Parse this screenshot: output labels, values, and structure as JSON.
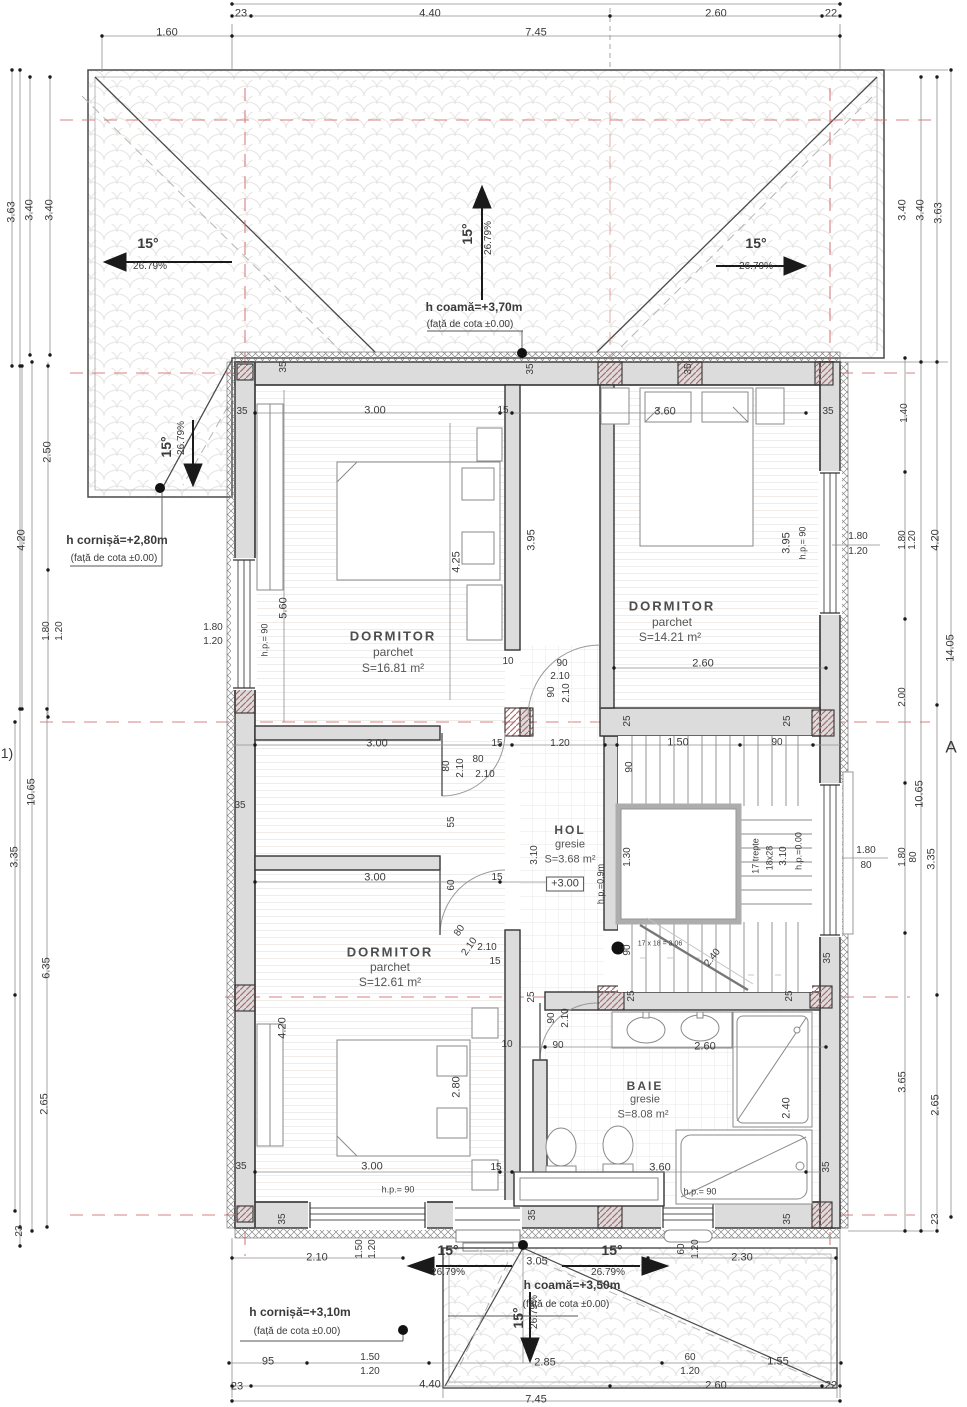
{
  "plan": {
    "rooms": [
      {
        "name": "DORMITOR",
        "floor": "parchet",
        "area": "S=16.81 m²"
      },
      {
        "name": "DORMITOR",
        "floor": "parchet",
        "area": "S=14.21 m²"
      },
      {
        "name": "DORMITOR",
        "floor": "parchet",
        "area": "S=12.61 m²"
      },
      {
        "name": "HOL",
        "floor": "gresie",
        "area": "S=3.68 m²"
      },
      {
        "name": "BAIE",
        "floor": "gresie",
        "area": "S=8.08 m²"
      }
    ],
    "level_marker": "+3.00",
    "roof": {
      "slope_deg": "15°",
      "slope_pct": "26.79%",
      "ridge_top": "h coamă=+3,70m",
      "eave_left": "h cornișă=+2,80m",
      "ridge_bottom": "h coamă=+3,50m",
      "eave_bottom": "h cornișă=+3,10m",
      "datum_note": "(față de cota ±0.00)"
    },
    "stairs": {
      "steps": "17 trepte",
      "tread": "18x28",
      "rise_total": "3.10",
      "formula": "17 x 18 = 3.06"
    },
    "axis_markers": {
      "left": "1)",
      "right": "A"
    },
    "colors": {
      "axis_red": "#d06a6a",
      "wall_fill": "#dcdcdc",
      "pier_hatch": "#b06a6d",
      "line": "#4a4a4a"
    }
  },
  "labels": [
    {
      "t": "23",
      "x": 241,
      "y": 14,
      "n": "dim"
    },
    {
      "t": "4.40",
      "x": 430,
      "y": 14,
      "n": "dim"
    },
    {
      "t": "2.60",
      "x": 716,
      "y": 14,
      "n": "dim"
    },
    {
      "t": "22",
      "x": 831,
      "y": 14,
      "n": "dim"
    },
    {
      "t": "1.60",
      "x": 167,
      "y": 33,
      "n": "dim"
    },
    {
      "t": "7.45",
      "x": 536,
      "y": 33,
      "n": "dim"
    },
    {
      "t": "3.63",
      "x": 12,
      "y": 212,
      "r": -90,
      "n": "dim"
    },
    {
      "t": "3.40",
      "x": 30,
      "y": 210,
      "r": -90,
      "n": "dim"
    },
    {
      "t": "3.40",
      "x": 50,
      "y": 210,
      "r": -90,
      "n": "dim"
    },
    {
      "t": "2.50",
      "x": 48,
      "y": 452,
      "r": -90,
      "n": "dim"
    },
    {
      "t": "4.20",
      "x": 22,
      "y": 540,
      "r": -90,
      "n": "dim"
    },
    {
      "t": "1.80",
      "x": 47,
      "y": 631,
      "r": -90,
      "s": 10,
      "n": "dim"
    },
    {
      "t": "1.20",
      "x": 60,
      "y": 631,
      "r": -90,
      "s": 10,
      "n": "dim"
    },
    {
      "t": "10.65",
      "x": 32,
      "y": 792,
      "r": -90,
      "n": "dim"
    },
    {
      "t": "3.35",
      "x": 15,
      "y": 857,
      "r": -90,
      "n": "dim"
    },
    {
      "t": "6.35",
      "x": 47,
      "y": 968,
      "r": -90,
      "n": "dim"
    },
    {
      "t": "2.65",
      "x": 45,
      "y": 1104,
      "r": -90,
      "n": "dim"
    },
    {
      "t": "23",
      "x": 20,
      "y": 1231,
      "r": -90,
      "s": 10,
      "n": "dim"
    },
    {
      "t": "1)",
      "x": 7,
      "y": 753,
      "s": 14,
      "n": "axis-marker"
    },
    {
      "t": "3.40",
      "x": 903,
      "y": 210,
      "r": -90,
      "n": "dim"
    },
    {
      "t": "3.40",
      "x": 921,
      "y": 210,
      "r": -90,
      "n": "dim"
    },
    {
      "t": "3.63",
      "x": 939,
      "y": 213,
      "r": -90,
      "n": "dim"
    },
    {
      "t": "1.40",
      "x": 905,
      "y": 413,
      "r": -90,
      "s": 10,
      "n": "dim"
    },
    {
      "t": "1.80",
      "x": 903,
      "y": 540,
      "r": -90,
      "s": 10,
      "n": "dim"
    },
    {
      "t": "1.20",
      "x": 913,
      "y": 540,
      "r": -90,
      "s": 10,
      "n": "dim"
    },
    {
      "t": "4.20",
      "x": 936,
      "y": 540,
      "r": -90,
      "n": "dim"
    },
    {
      "t": "14.05",
      "x": 951,
      "y": 648,
      "r": -90,
      "n": "dim"
    },
    {
      "t": "2.00",
      "x": 903,
      "y": 697,
      "r": -90,
      "s": 10,
      "n": "dim"
    },
    {
      "t": "A",
      "x": 951,
      "y": 747,
      "s": 17,
      "n": "axis-marker"
    },
    {
      "t": "10.65",
      "x": 920,
      "y": 794,
      "r": -90,
      "n": "dim"
    },
    {
      "t": "1.80",
      "x": 903,
      "y": 857,
      "r": -90,
      "s": 10,
      "n": "dim"
    },
    {
      "t": "80",
      "x": 914,
      "y": 857,
      "r": -90,
      "s": 10,
      "n": "dim"
    },
    {
      "t": "3.35",
      "x": 932,
      "y": 859,
      "r": -90,
      "n": "dim"
    },
    {
      "t": "3.65",
      "x": 903,
      "y": 1082,
      "r": -90,
      "n": "dim"
    },
    {
      "t": "2.65",
      "x": 936,
      "y": 1105,
      "r": -90,
      "n": "dim"
    },
    {
      "t": "23",
      "x": 936,
      "y": 1219,
      "r": -90,
      "s": 10,
      "n": "dim"
    },
    {
      "t": "1.80",
      "x": 858,
      "y": 537,
      "s": 10,
      "n": "window-dim"
    },
    {
      "t": "1.20",
      "x": 858,
      "y": 552,
      "s": 10,
      "n": "window-dim"
    },
    {
      "t": "1.80",
      "x": 866,
      "y": 851,
      "s": 10,
      "n": "window-dim"
    },
    {
      "t": "80",
      "x": 866,
      "y": 866,
      "s": 10,
      "n": "window-dim"
    },
    {
      "t": "2.10",
      "x": 317,
      "y": 1258,
      "n": "dim"
    },
    {
      "t": "1.50",
      "x": 360,
      "y": 1249,
      "r": -90,
      "s": 10,
      "n": "dim"
    },
    {
      "t": "1.20",
      "x": 373,
      "y": 1249,
      "r": -90,
      "s": 10,
      "n": "dim"
    },
    {
      "t": "60",
      "x": 682,
      "y": 1249,
      "r": -90,
      "s": 10,
      "n": "dim"
    },
    {
      "t": "1.20",
      "x": 696,
      "y": 1249,
      "r": -90,
      "s": 10,
      "n": "dim"
    },
    {
      "t": "2.30",
      "x": 742,
      "y": 1258,
      "n": "dim"
    },
    {
      "t": "95",
      "x": 268,
      "y": 1362,
      "n": "dim"
    },
    {
      "t": "1.50",
      "x": 370,
      "y": 1358,
      "s": 10,
      "n": "dim"
    },
    {
      "t": "1.20",
      "x": 370,
      "y": 1372,
      "s": 10,
      "n": "dim"
    },
    {
      "t": "2.85",
      "x": 545,
      "y": 1363,
      "n": "dim"
    },
    {
      "t": "60",
      "x": 690,
      "y": 1358,
      "s": 10,
      "n": "dim"
    },
    {
      "t": "1.20",
      "x": 690,
      "y": 1372,
      "s": 10,
      "n": "dim"
    },
    {
      "t": "1.55",
      "x": 778,
      "y": 1362,
      "n": "dim"
    },
    {
      "t": "23",
      "x": 237,
      "y": 1387,
      "n": "dim"
    },
    {
      "t": "4.40",
      "x": 430,
      "y": 1385,
      "n": "dim"
    },
    {
      "t": "2.60",
      "x": 716,
      "y": 1386,
      "n": "dim"
    },
    {
      "t": "22",
      "x": 831,
      "y": 1386,
      "n": "dim"
    },
    {
      "t": "7.45",
      "x": 536,
      "y": 1400,
      "n": "dim"
    },
    {
      "t": "3.05",
      "x": 537,
      "y": 1262,
      "n": "dim"
    },
    {
      "t": "15°",
      "x": 448,
      "y": 1250,
      "s": 14,
      "b": 1,
      "n": "slope-angle"
    },
    {
      "t": "26.79%",
      "x": 448,
      "y": 1273,
      "s": 10,
      "n": "slope-percent"
    },
    {
      "t": "15°",
      "x": 612,
      "y": 1250,
      "s": 14,
      "b": 1,
      "n": "slope-angle"
    },
    {
      "t": "26.79%",
      "x": 608,
      "y": 1273,
      "s": 10,
      "n": "slope-percent"
    },
    {
      "t": "15°",
      "x": 518,
      "y": 1318,
      "r": -90,
      "s": 14,
      "b": 1,
      "n": "slope-angle"
    },
    {
      "t": "26.79%",
      "x": 535,
      "y": 1312,
      "r": -90,
      "s": 10,
      "n": "slope-percent"
    },
    {
      "t": "h coamă=+3,50m",
      "x": 572,
      "y": 1285,
      "s": 12,
      "b": 1,
      "n": "ridge-height-label"
    },
    {
      "t": "(față de cota ±0.00)",
      "x": 566,
      "y": 1305,
      "s": 10,
      "n": "datum-label"
    },
    {
      "t": "h cornișă=+3,10m",
      "x": 300,
      "y": 1312,
      "s": 12,
      "b": 1,
      "n": "eave-height-label"
    },
    {
      "t": "(față de cota ±0.00)",
      "x": 297,
      "y": 1332,
      "s": 10,
      "n": "datum-label"
    },
    {
      "t": "15°",
      "x": 148,
      "y": 243,
      "s": 14,
      "b": 1,
      "n": "slope-angle"
    },
    {
      "t": "26.79%",
      "x": 150,
      "y": 267,
      "s": 10,
      "n": "slope-percent"
    },
    {
      "t": "15°",
      "x": 467,
      "y": 234,
      "r": -90,
      "s": 14,
      "b": 1,
      "n": "slope-angle"
    },
    {
      "t": "26.79%",
      "x": 489,
      "y": 238,
      "r": -90,
      "s": 10,
      "n": "slope-percent"
    },
    {
      "t": "15°",
      "x": 756,
      "y": 243,
      "s": 14,
      "b": 1,
      "n": "slope-angle"
    },
    {
      "t": "26.79%",
      "x": 756,
      "y": 267,
      "s": 10,
      "n": "slope-percent"
    },
    {
      "t": "15°",
      "x": 166,
      "y": 447,
      "r": -90,
      "s": 14,
      "b": 1,
      "n": "slope-angle"
    },
    {
      "t": "26.79%",
      "x": 182,
      "y": 438,
      "r": -90,
      "s": 10,
      "n": "slope-percent"
    },
    {
      "t": "h coamă=+3,70m",
      "x": 474,
      "y": 307,
      "s": 12,
      "b": 1,
      "n": "ridge-height-label"
    },
    {
      "t": "(față de cota ±0.00)",
      "x": 470,
      "y": 325,
      "s": 10,
      "n": "datum-label"
    },
    {
      "t": "h cornișă=+2,80m",
      "x": 117,
      "y": 540,
      "s": 12,
      "b": 1,
      "n": "eave-height-label"
    },
    {
      "t": "(față de cota ±0.00)",
      "x": 114,
      "y": 559,
      "s": 10,
      "n": "datum-label"
    },
    {
      "t": "35",
      "x": 242,
      "y": 412,
      "s": 10,
      "n": "wall-dim"
    },
    {
      "t": "3.00",
      "x": 375,
      "y": 411,
      "n": "dim"
    },
    {
      "t": "15",
      "x": 503,
      "y": 411,
      "s": 10,
      "n": "wall-dim"
    },
    {
      "t": "3.60",
      "x": 665,
      "y": 412,
      "n": "dim"
    },
    {
      "t": "35",
      "x": 828,
      "y": 412,
      "s": 10,
      "n": "wall-dim"
    },
    {
      "t": "35",
      "x": 284,
      "y": 367,
      "r": -90,
      "s": 10,
      "n": "wall-dim"
    },
    {
      "t": "35",
      "x": 531,
      "y": 369,
      "r": -90,
      "s": 10,
      "n": "wall-dim"
    },
    {
      "t": "35",
      "x": 689,
      "y": 369,
      "r": -90,
      "s": 10,
      "n": "wall-dim"
    },
    {
      "t": "4.25",
      "x": 457,
      "y": 562,
      "r": -90,
      "n": "dim"
    },
    {
      "t": "5.60",
      "x": 284,
      "y": 608,
      "r": -90,
      "n": "dim"
    },
    {
      "t": "h.p.= 90",
      "x": 265,
      "y": 640,
      "r": -90,
      "s": 9,
      "n": "parapet-label"
    },
    {
      "t": "1.80",
      "x": 213,
      "y": 628,
      "s": 10,
      "n": "window-dim"
    },
    {
      "t": "1.20",
      "x": 213,
      "y": 642,
      "s": 10,
      "n": "window-dim"
    },
    {
      "t": "3.95",
      "x": 532,
      "y": 540,
      "r": -90,
      "n": "dim"
    },
    {
      "t": "3.95",
      "x": 787,
      "y": 543,
      "r": -90,
      "n": "dim"
    },
    {
      "t": "h.p.= 90",
      "x": 803,
      "y": 543,
      "r": -90,
      "s": 9,
      "n": "parapet-label"
    },
    {
      "t": "2.60",
      "x": 703,
      "y": 664,
      "n": "dim"
    },
    {
      "t": "10",
      "x": 508,
      "y": 662,
      "s": 10,
      "n": "wall-dim"
    },
    {
      "t": "90",
      "x": 562,
      "y": 664,
      "s": 10,
      "n": "door-dim"
    },
    {
      "t": "2.10",
      "x": 560,
      "y": 677,
      "s": 10,
      "n": "door-dim"
    },
    {
      "t": "90",
      "x": 552,
      "y": 692,
      "r": -90,
      "s": 10,
      "n": "door-dim"
    },
    {
      "t": "2.10",
      "x": 567,
      "y": 693,
      "r": -90,
      "s": 10,
      "n": "door-dim"
    },
    {
      "t": "DORMITOR",
      "x": 393,
      "y": 636,
      "s": 13,
      "b": 1,
      "k": "sp",
      "n": "room-name"
    },
    {
      "t": "parchet",
      "x": 393,
      "y": 652,
      "s": 12,
      "k": "rm",
      "n": "room-floor"
    },
    {
      "t": "S=16.81 m²",
      "x": 393,
      "y": 668,
      "s": 12,
      "k": "rm",
      "n": "room-area"
    },
    {
      "t": "DORMITOR",
      "x": 672,
      "y": 606,
      "s": 13,
      "b": 1,
      "k": "sp",
      "n": "room-name"
    },
    {
      "t": "parchet",
      "x": 672,
      "y": 622,
      "s": 12,
      "k": "rm",
      "n": "room-floor"
    },
    {
      "t": "S=14.21 m²",
      "x": 670,
      "y": 637,
      "s": 12,
      "k": "rm",
      "n": "room-area"
    },
    {
      "t": "DORMITOR",
      "x": 390,
      "y": 952,
      "s": 13,
      "b": 1,
      "k": "sp",
      "n": "room-name"
    },
    {
      "t": "parchet",
      "x": 390,
      "y": 967,
      "s": 12,
      "k": "rm",
      "n": "room-floor"
    },
    {
      "t": "S=12.61 m²",
      "x": 390,
      "y": 982,
      "s": 12,
      "k": "rm",
      "n": "room-area"
    },
    {
      "t": "HOL",
      "x": 570,
      "y": 830,
      "s": 12,
      "b": 1,
      "k": "sp",
      "n": "room-name"
    },
    {
      "t": "gresie",
      "x": 570,
      "y": 845,
      "s": 11,
      "k": "rm",
      "n": "room-floor"
    },
    {
      "t": "S=3.68 m²",
      "x": 570,
      "y": 860,
      "s": 11,
      "k": "rm",
      "n": "room-area"
    },
    {
      "t": "+3.00",
      "x": 565,
      "y": 884,
      "s": 11,
      "k": "box",
      "n": "level-badge"
    },
    {
      "t": "BAIE",
      "x": 645,
      "y": 1086,
      "s": 12,
      "b": 1,
      "k": "sp",
      "n": "room-name"
    },
    {
      "t": "gresie",
      "x": 645,
      "y": 1100,
      "s": 11,
      "k": "rm",
      "n": "room-floor"
    },
    {
      "t": "S=8.08 m²",
      "x": 643,
      "y": 1115,
      "s": 11,
      "k": "rm",
      "n": "room-area"
    },
    {
      "t": "3.00",
      "x": 377,
      "y": 744,
      "n": "dim"
    },
    {
      "t": "15",
      "x": 497,
      "y": 744,
      "s": 10,
      "n": "wall-dim"
    },
    {
      "t": "1.20",
      "x": 560,
      "y": 744,
      "s": 10,
      "n": "dim"
    },
    {
      "t": "1.50",
      "x": 678,
      "y": 743,
      "n": "dim"
    },
    {
      "t": "90",
      "x": 777,
      "y": 743,
      "s": 10,
      "n": "dim"
    },
    {
      "t": "25",
      "x": 628,
      "y": 721,
      "r": -90,
      "s": 10,
      "n": "wall-dim"
    },
    {
      "t": "25",
      "x": 788,
      "y": 721,
      "r": -90,
      "s": 10,
      "n": "wall-dim"
    },
    {
      "t": "80",
      "x": 478,
      "y": 760,
      "s": 10,
      "n": "door-dim"
    },
    {
      "t": "2.10",
      "x": 485,
      "y": 775,
      "s": 10,
      "n": "door-dim"
    },
    {
      "t": "80",
      "x": 447,
      "y": 766,
      "r": -90,
      "s": 10,
      "n": "door-dim"
    },
    {
      "t": "2.10",
      "x": 461,
      "y": 768,
      "r": -90,
      "s": 10,
      "n": "door-dim"
    },
    {
      "t": "90",
      "x": 630,
      "y": 767,
      "r": -90,
      "s": 10,
      "n": "dim"
    },
    {
      "t": "55",
      "x": 452,
      "y": 822,
      "r": -90,
      "s": 10,
      "n": "dim"
    },
    {
      "t": "3.10",
      "x": 535,
      "y": 855,
      "r": -90,
      "s": 10,
      "n": "dim"
    },
    {
      "t": "h.p.=0.9m",
      "x": 601,
      "y": 884,
      "r": -90,
      "s": 9,
      "n": "parapet-label"
    },
    {
      "t": "1.30",
      "x": 628,
      "y": 857,
      "r": -90,
      "s": 10,
      "n": "dim"
    },
    {
      "t": "17 trepte",
      "x": 756,
      "y": 856,
      "r": -90,
      "s": 9,
      "n": "stair-note"
    },
    {
      "t": "18x28",
      "x": 770,
      "y": 858,
      "r": -90,
      "s": 9,
      "n": "stair-note"
    },
    {
      "t": "3.10",
      "x": 784,
      "y": 856,
      "r": -90,
      "s": 10,
      "n": "stair-note"
    },
    {
      "t": "h.p.=0.00",
      "x": 799,
      "y": 851,
      "r": -90,
      "s": 9,
      "n": "parapet-label"
    },
    {
      "t": "60",
      "x": 452,
      "y": 885,
      "r": -90,
      "s": 10,
      "n": "dim"
    },
    {
      "t": "15",
      "x": 497,
      "y": 878,
      "s": 10,
      "n": "wall-dim"
    },
    {
      "t": "3.00",
      "x": 375,
      "y": 878,
      "n": "dim"
    },
    {
      "t": "17 x 18 = 3.06",
      "x": 660,
      "y": 944,
      "s": 7,
      "n": "stair-note"
    },
    {
      "t": "90",
      "x": 628,
      "y": 950,
      "r": -90,
      "s": 10,
      "n": "dim"
    },
    {
      "t": "2.40",
      "x": 713,
      "y": 958,
      "r": -52,
      "s": 10,
      "n": "dim"
    },
    {
      "t": "35",
      "x": 828,
      "y": 958,
      "r": -90,
      "s": 10,
      "n": "wall-dim"
    },
    {
      "t": "80",
      "x": 460,
      "y": 931,
      "r": -55,
      "s": 10,
      "n": "door-dim"
    },
    {
      "t": "2.10",
      "x": 470,
      "y": 947,
      "r": -55,
      "s": 10,
      "n": "door-dim"
    },
    {
      "t": "2.10",
      "x": 487,
      "y": 948,
      "s": 10,
      "n": "door-dim"
    },
    {
      "t": "15",
      "x": 495,
      "y": 962,
      "s": 10,
      "n": "wall-dim"
    },
    {
      "t": "25",
      "x": 532,
      "y": 997,
      "r": -90,
      "s": 10,
      "n": "wall-dim"
    },
    {
      "t": "25",
      "x": 632,
      "y": 996,
      "r": -90,
      "s": 10,
      "n": "wall-dim"
    },
    {
      "t": "25",
      "x": 790,
      "y": 996,
      "r": -90,
      "s": 10,
      "n": "wall-dim"
    },
    {
      "t": "90",
      "x": 552,
      "y": 1018,
      "r": -90,
      "s": 10,
      "n": "door-dim"
    },
    {
      "t": "2.10",
      "x": 566,
      "y": 1018,
      "r": -90,
      "s": 10,
      "n": "door-dim"
    },
    {
      "t": "90",
      "x": 558,
      "y": 1046,
      "s": 10,
      "n": "door-dim"
    },
    {
      "t": "2.60",
      "x": 705,
      "y": 1047,
      "n": "dim"
    },
    {
      "t": "10",
      "x": 507,
      "y": 1045,
      "s": 10,
      "n": "wall-dim"
    },
    {
      "t": "4.20",
      "x": 283,
      "y": 1028,
      "r": -90,
      "n": "dim"
    },
    {
      "t": "2.80",
      "x": 457,
      "y": 1087,
      "r": -90,
      "n": "dim"
    },
    {
      "t": "2.40",
      "x": 787,
      "y": 1108,
      "r": -90,
      "n": "dim"
    },
    {
      "t": "35",
      "x": 241,
      "y": 1167,
      "s": 10,
      "n": "wall-dim"
    },
    {
      "t": "3.00",
      "x": 372,
      "y": 1167,
      "n": "dim"
    },
    {
      "t": "15",
      "x": 496,
      "y": 1168,
      "s": 10,
      "n": "wall-dim"
    },
    {
      "t": "3.60",
      "x": 660,
      "y": 1168,
      "n": "dim"
    },
    {
      "t": "35",
      "x": 827,
      "y": 1167,
      "r": -90,
      "s": 10,
      "n": "wall-dim"
    },
    {
      "t": "h.p.= 90",
      "x": 398,
      "y": 1190,
      "s": 9,
      "n": "parapet-label"
    },
    {
      "t": "h.p.= 90",
      "x": 700,
      "y": 1192,
      "s": 9,
      "n": "parapet-label"
    },
    {
      "t": "35",
      "x": 283,
      "y": 1219,
      "r": -90,
      "s": 10,
      "n": "wall-dim"
    },
    {
      "t": "35",
      "x": 533,
      "y": 1215,
      "r": -90,
      "s": 10,
      "n": "wall-dim"
    },
    {
      "t": "35",
      "x": 788,
      "y": 1219,
      "r": -90,
      "s": 10,
      "n": "wall-dim"
    },
    {
      "t": "35",
      "x": 240,
      "y": 806,
      "s": 10,
      "n": "wall-dim"
    }
  ]
}
